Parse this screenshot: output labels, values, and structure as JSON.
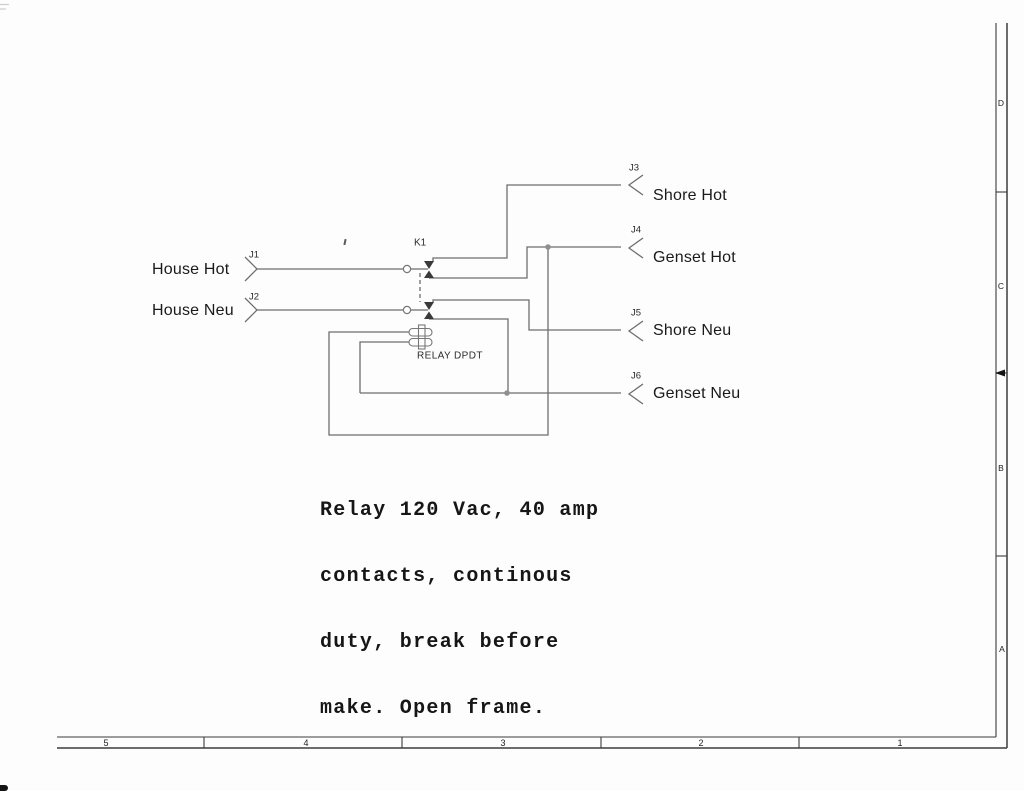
{
  "schematic": {
    "left_connectors": [
      {
        "ref": "J1",
        "label": "House Hot"
      },
      {
        "ref": "J2",
        "label": "House Neu"
      }
    ],
    "right_connectors": [
      {
        "ref": "J3",
        "label": "Shore Hot"
      },
      {
        "ref": "J4",
        "label": "Genset Hot"
      },
      {
        "ref": "J5",
        "label": "Shore Neu"
      },
      {
        "ref": "J6",
        "label": "Genset Neu"
      }
    ],
    "relay": {
      "designator": "K1",
      "type_label": "RELAY DPDT"
    },
    "note_lines": [
      "Relay 120 Vac, 40 amp",
      "contacts, continous",
      "duty, break before",
      "make. Open frame."
    ]
  },
  "frame": {
    "row_labels": [
      "D",
      "C",
      "B",
      "A"
    ],
    "column_labels": [
      "5",
      "4",
      "3",
      "2",
      "1"
    ]
  },
  "colors": {
    "wire": "#6e6e6e",
    "contact": "#3a3a3a",
    "junction": "#8f8f8f",
    "border": "#3c3c3c",
    "text": "#1a1a1a",
    "background": "#fdfdfd"
  }
}
